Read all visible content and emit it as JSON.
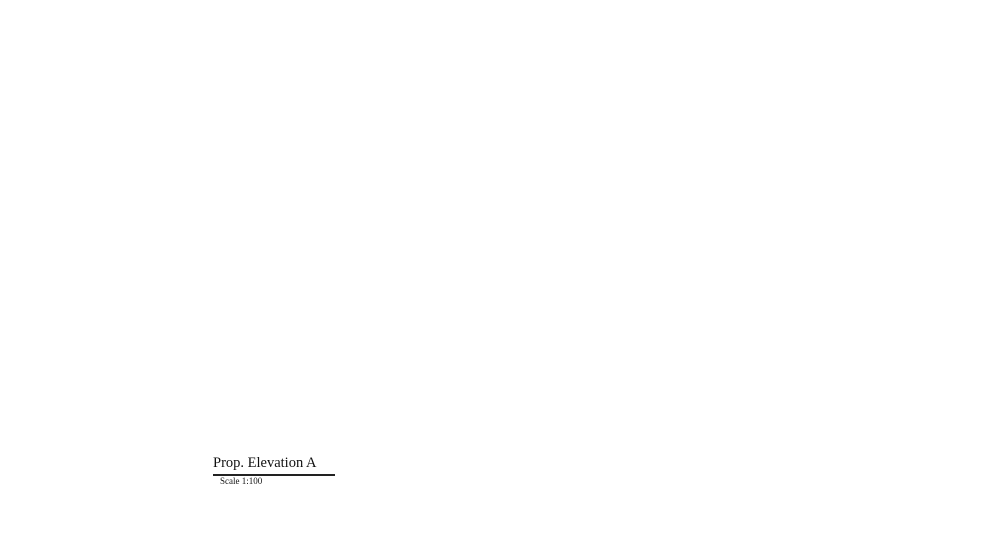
{
  "drawing": {
    "title": "Prop. Elevation A",
    "scale": "Scale 1:100",
    "right_labels": [
      "White PVC Apertures",
      "Glazed Railing",
      "Light Brown Rendering",
      "White PVC Apertures",
      "Glazed Railing",
      "White Rendering",
      "Magnolia Rendering",
      "White PVC Apertures",
      "Natural Stone Cladding",
      "White PVC Apertures",
      "White PVC Railing",
      "Timber Main Doors",
      "White PVC Garage Door"
    ],
    "inline_labels": [
      "Glass Railing",
      "Glass Railing",
      "Glass Railing"
    ],
    "watermark_text": "sensaramalta",
    "colors": {
      "window_glass": "#bed8ed",
      "window_frame": "#6d89a3",
      "brown_render": "#7a5f52",
      "balcony_tan": "#dfc9a4",
      "slab_edge": "#6f5a49",
      "stone": "#e3d0ac",
      "stone_course": "#cdb68d",
      "panel_brown": "#6e5647",
      "leader_magenta": "#e36ac4",
      "parapet_gray": "#ececee",
      "watermark_red": "#b86c68"
    }
  }
}
